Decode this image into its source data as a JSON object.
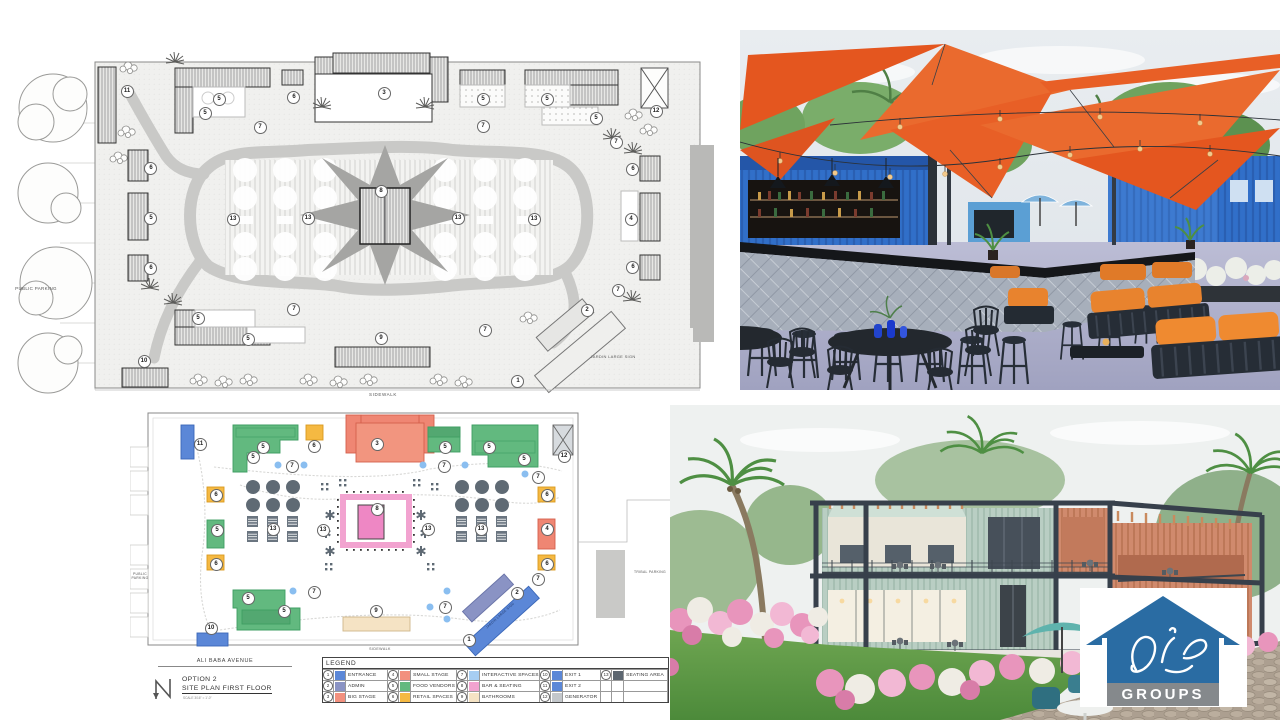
{
  "bw_plan": {
    "labels": {
      "public_parking": "PUBLIC PARKING",
      "sidewalk": "SIDEWALK",
      "jardin_sign": "JARDIN LARGE SIGN"
    },
    "markers": [
      {
        "n": "11",
        "x": 118,
        "y": 62
      },
      {
        "n": "5",
        "x": 210,
        "y": 70
      },
      {
        "n": "5",
        "x": 196,
        "y": 84
      },
      {
        "n": "6",
        "x": 285,
        "y": 69
      },
      {
        "n": "3",
        "x": 375,
        "y": 65
      },
      {
        "n": "5",
        "x": 474,
        "y": 70
      },
      {
        "n": "5",
        "x": 538,
        "y": 70
      },
      {
        "n": "5",
        "x": 587,
        "y": 89
      },
      {
        "n": "12",
        "x": 647,
        "y": 82
      },
      {
        "n": "7",
        "x": 251,
        "y": 98
      },
      {
        "n": "7",
        "x": 474,
        "y": 97
      },
      {
        "n": "7",
        "x": 607,
        "y": 113
      },
      {
        "n": "6",
        "x": 142,
        "y": 139
      },
      {
        "n": "6",
        "x": 624,
        "y": 140
      },
      {
        "n": "5",
        "x": 142,
        "y": 189
      },
      {
        "n": "4",
        "x": 622,
        "y": 190
      },
      {
        "n": "6",
        "x": 142,
        "y": 239
      },
      {
        "n": "6",
        "x": 624,
        "y": 238
      },
      {
        "n": "13",
        "x": 224,
        "y": 190
      },
      {
        "n": "13",
        "x": 299,
        "y": 189
      },
      {
        "n": "8",
        "x": 372,
        "y": 162
      },
      {
        "n": "13",
        "x": 449,
        "y": 189
      },
      {
        "n": "13",
        "x": 525,
        "y": 190
      },
      {
        "n": "7",
        "x": 285,
        "y": 280
      },
      {
        "n": "7",
        "x": 609,
        "y": 261
      },
      {
        "n": "7",
        "x": 476,
        "y": 301
      },
      {
        "n": "5",
        "x": 189,
        "y": 290
      },
      {
        "n": "5",
        "x": 239,
        "y": 310
      },
      {
        "n": "9",
        "x": 372,
        "y": 309
      },
      {
        "n": "10",
        "x": 135,
        "y": 332
      },
      {
        "n": "2",
        "x": 578,
        "y": 281
      },
      {
        "n": "1",
        "x": 509,
        "y": 352
      }
    ]
  },
  "color_plan": {
    "labels": {
      "public_parking": "PUBLIC PARKING",
      "tribal_parking": "TRIBAL PARKING",
      "sidewalk": "SIDEWALK",
      "jardin_sign": "JARDIN LARGE SIGN",
      "avenue": "ALI BABA AVENUE"
    },
    "title_block": {
      "option": "OPTION 2",
      "title": "SITE PLAN FIRST FLOOR",
      "scale": "SCALE 3/16\" = 1'-0\""
    },
    "legend": {
      "title": "LEGEND",
      "items": [
        {
          "number": "1",
          "label": "ENTRANCE",
          "color": "#5b87d7"
        },
        {
          "number": "2",
          "label": "ADMIN",
          "color": "#8a93c4"
        },
        {
          "number": "3",
          "label": "BIG STAGE",
          "color": "#f2907e"
        },
        {
          "number": "4",
          "label": "SMALL STAGE",
          "color": "#f2907e"
        },
        {
          "number": "5",
          "label": "FOOD VENDORS",
          "color": "#62b97f"
        },
        {
          "number": "6",
          "label": "RETAIL SPACES",
          "color": "#f5b942"
        },
        {
          "number": "7",
          "label": "INTERACTIVE SPACES",
          "color": "#a6cdf2"
        },
        {
          "number": "8",
          "label": "BAR & SEATING",
          "color": "#f2a3d0"
        },
        {
          "number": "9",
          "label": "BATHROOMS",
          "color": "#f5e3c4"
        },
        {
          "number": "10",
          "label": "EXIT 1",
          "color": "#5b87d7"
        },
        {
          "number": "11",
          "label": "EXIT 2",
          "color": "#5b87d7"
        },
        {
          "number": "12",
          "label": "GENERATOR",
          "color": "#c3c7cb"
        },
        {
          "number": "13",
          "label": "SEATING AREA",
          "color": "#5c6670"
        }
      ]
    },
    "markers": [
      {
        "n": "11",
        "x": 69,
        "y": 38
      },
      {
        "n": "5",
        "x": 132,
        "y": 41
      },
      {
        "n": "5",
        "x": 122,
        "y": 51
      },
      {
        "n": "6",
        "x": 183,
        "y": 40
      },
      {
        "n": "3",
        "x": 246,
        "y": 38
      },
      {
        "n": "5",
        "x": 314,
        "y": 41
      },
      {
        "n": "5",
        "x": 358,
        "y": 41
      },
      {
        "n": "5",
        "x": 393,
        "y": 53
      },
      {
        "n": "12",
        "x": 433,
        "y": 50
      },
      {
        "n": "7",
        "x": 161,
        "y": 60
      },
      {
        "n": "7",
        "x": 313,
        "y": 60
      },
      {
        "n": "7",
        "x": 407,
        "y": 71
      },
      {
        "n": "6",
        "x": 85,
        "y": 89
      },
      {
        "n": "6",
        "x": 416,
        "y": 89
      },
      {
        "n": "5",
        "x": 86,
        "y": 124
      },
      {
        "n": "4",
        "x": 416,
        "y": 123
      },
      {
        "n": "13",
        "x": 142,
        "y": 123
      },
      {
        "n": "13",
        "x": 192,
        "y": 124
      },
      {
        "n": "8",
        "x": 246,
        "y": 103
      },
      {
        "n": "13",
        "x": 297,
        "y": 123
      },
      {
        "n": "13",
        "x": 350,
        "y": 123
      },
      {
        "n": "6",
        "x": 85,
        "y": 158
      },
      {
        "n": "6",
        "x": 416,
        "y": 158
      },
      {
        "n": "7",
        "x": 183,
        "y": 186
      },
      {
        "n": "7",
        "x": 407,
        "y": 173
      },
      {
        "n": "7",
        "x": 314,
        "y": 201
      },
      {
        "n": "5",
        "x": 117,
        "y": 192
      },
      {
        "n": "5",
        "x": 153,
        "y": 205
      },
      {
        "n": "9",
        "x": 245,
        "y": 205
      },
      {
        "n": "10",
        "x": 80,
        "y": 222
      },
      {
        "n": "2",
        "x": 386,
        "y": 187
      },
      {
        "n": "1",
        "x": 338,
        "y": 234
      }
    ]
  },
  "logo": {
    "text": "GROUPS"
  },
  "colors": {
    "sail_orange": "#e4602a",
    "container_blue": "#316fc9",
    "logo_blue": "#2a6ca3",
    "logo_gray": "#85898c",
    "lounge_orange": "#e8832e"
  }
}
